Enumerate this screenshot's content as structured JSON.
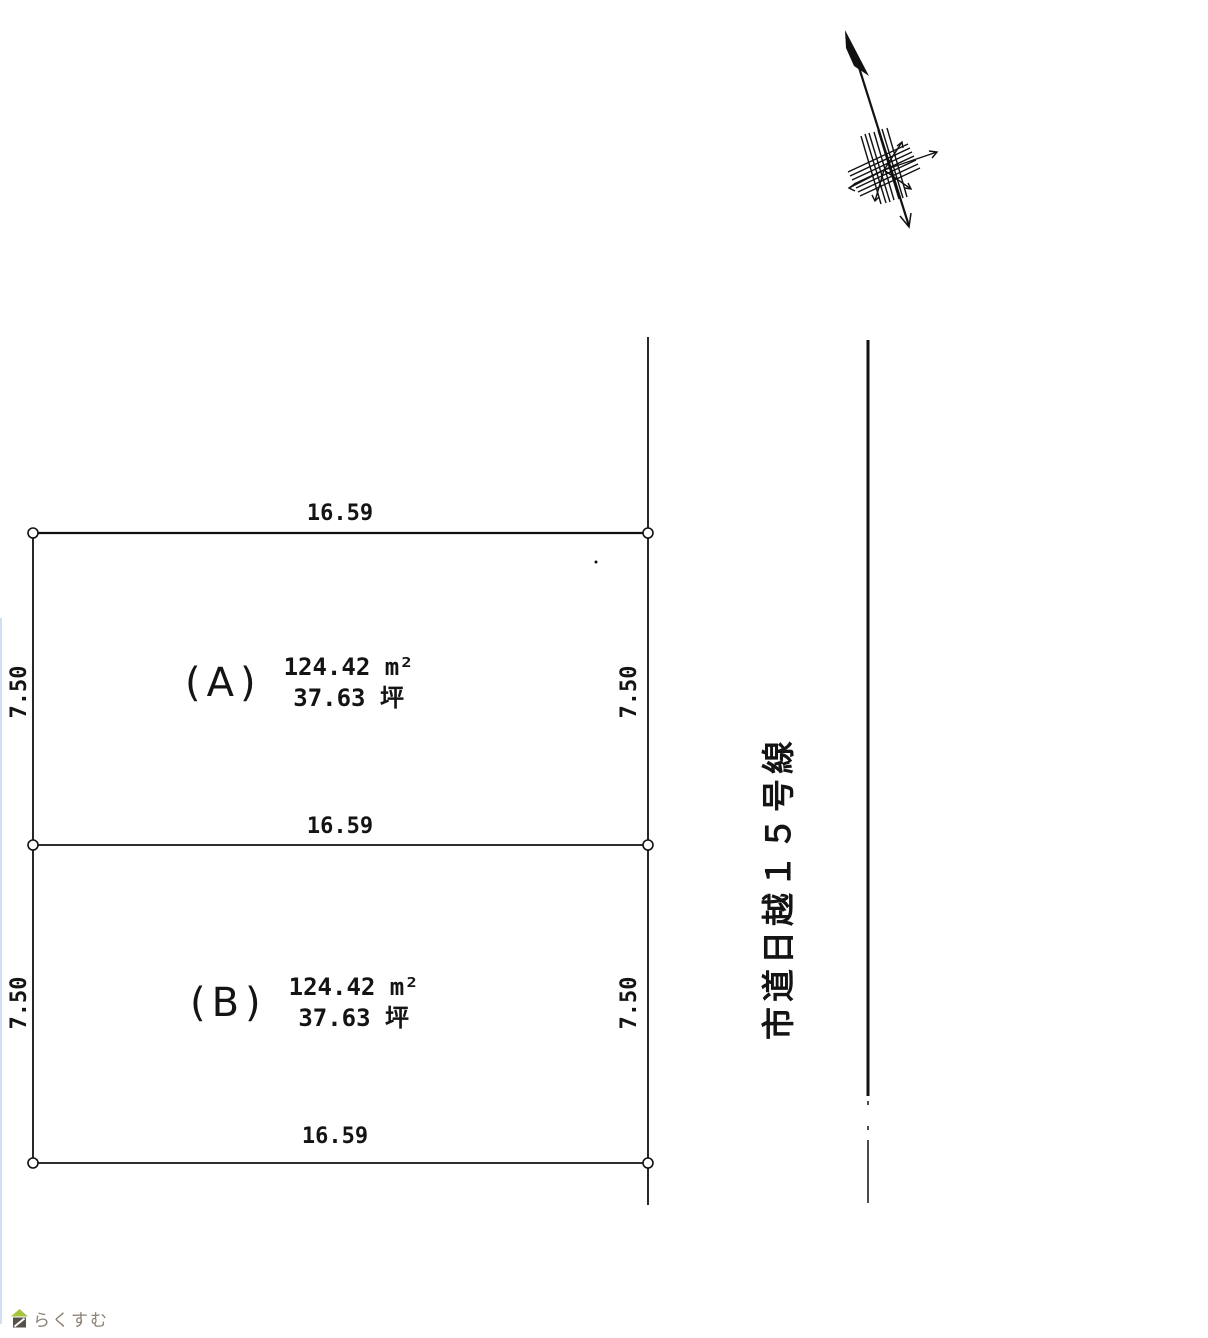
{
  "page": {
    "background": "#ffffff",
    "line_color": "#111111"
  },
  "plan": {
    "road": {
      "label": "市道日越１５号線"
    },
    "plots": [
      {
        "label": "(A)",
        "area_sqm": "124.42 m²",
        "area_tsubo": "37.63 坪"
      },
      {
        "label": "(B)",
        "area_sqm": "124.42 m²",
        "area_tsubo": "37.63 坪"
      }
    ],
    "dimensions": {
      "width_top": "16.59",
      "width_middle": "16.59",
      "width_bottom": "16.59",
      "height_a_left": "7.50",
      "height_a_right": "7.50",
      "height_b_left": "7.50",
      "height_b_right": "7.50"
    }
  },
  "icons": {
    "north_arrow": "north-arrow-icon",
    "house": "house-icon"
  },
  "watermark": {
    "brand": "らくすむ",
    "roof_color": "#a6c43b",
    "body_color": "#57504a",
    "text_color": "#8b8174"
  }
}
